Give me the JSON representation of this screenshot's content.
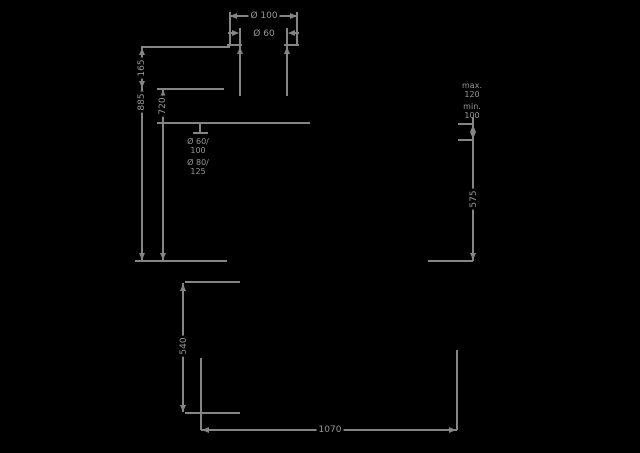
{
  "drawing": {
    "type": "technical-dimension-drawing",
    "colors": {
      "background": "#000000",
      "line": "#858585",
      "text": "#969696"
    },
    "flue": {
      "outer_dia": "Ø 100",
      "inner_dia": "Ø 60"
    },
    "left_dims": {
      "collar_height": "165",
      "total_height": "885",
      "body_height": "720"
    },
    "connection_label": {
      "l1": "Ø 60/",
      "l2": "100",
      "l3": "Ø 80/",
      "l4": "125"
    },
    "right_dims": {
      "note_l1": "max.",
      "note_l2": "120",
      "note_l3": "min.",
      "note_l4": "100",
      "height": "575"
    },
    "bottom_dims": {
      "clearance": "540",
      "width": "1070"
    }
  }
}
